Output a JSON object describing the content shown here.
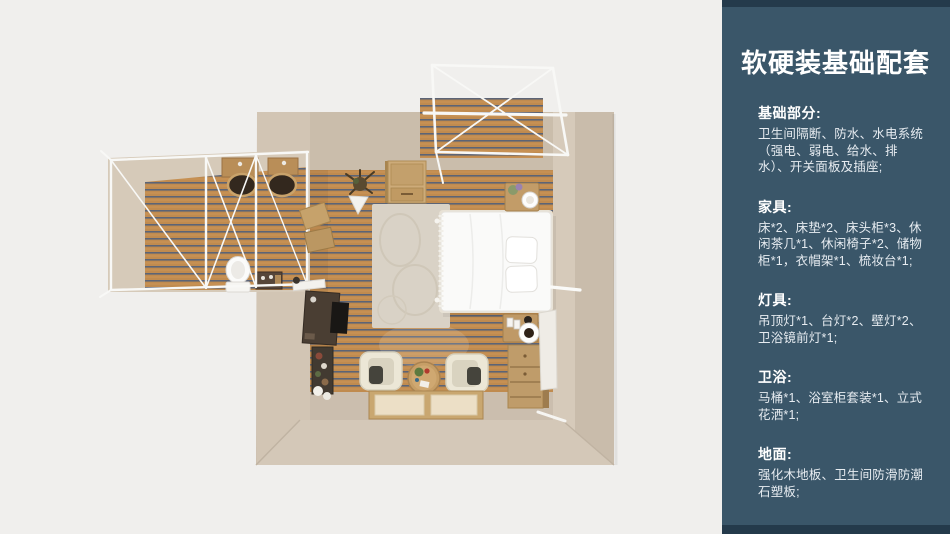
{
  "colors": {
    "panel_bg": "#3a5669",
    "panel_edge": "#243a4b",
    "canvas_bg": "#f0efed",
    "wall_beige": "#cec1b0",
    "wood_floor": "#c08b4f",
    "frame_white": "#f8f8f6"
  },
  "panel": {
    "title": "软硬装基础配套",
    "sections": [
      {
        "heading": "基础部分:",
        "body": "卫生间隔断、防水、水电系统（强电、弱电、给水、排水）、开关面板及插座;"
      },
      {
        "heading": "家具:",
        "body": "床*2、床垫*2、床头柜*3、休闲茶几*1、休闲椅子*2、储物柜*1，衣帽架*1、梳妆台*1;"
      },
      {
        "heading": "灯具:",
        "body": "吊顶灯*1、台灯*2、壁灯*2、卫浴镜前灯*1;"
      },
      {
        "heading": "卫浴:",
        "body": "马桶*1、浴室柜套装*1、立式花洒*1;"
      },
      {
        "heading": "地面:",
        "body": "强化木地板、卫生间防滑防潮石塑板;"
      }
    ]
  }
}
